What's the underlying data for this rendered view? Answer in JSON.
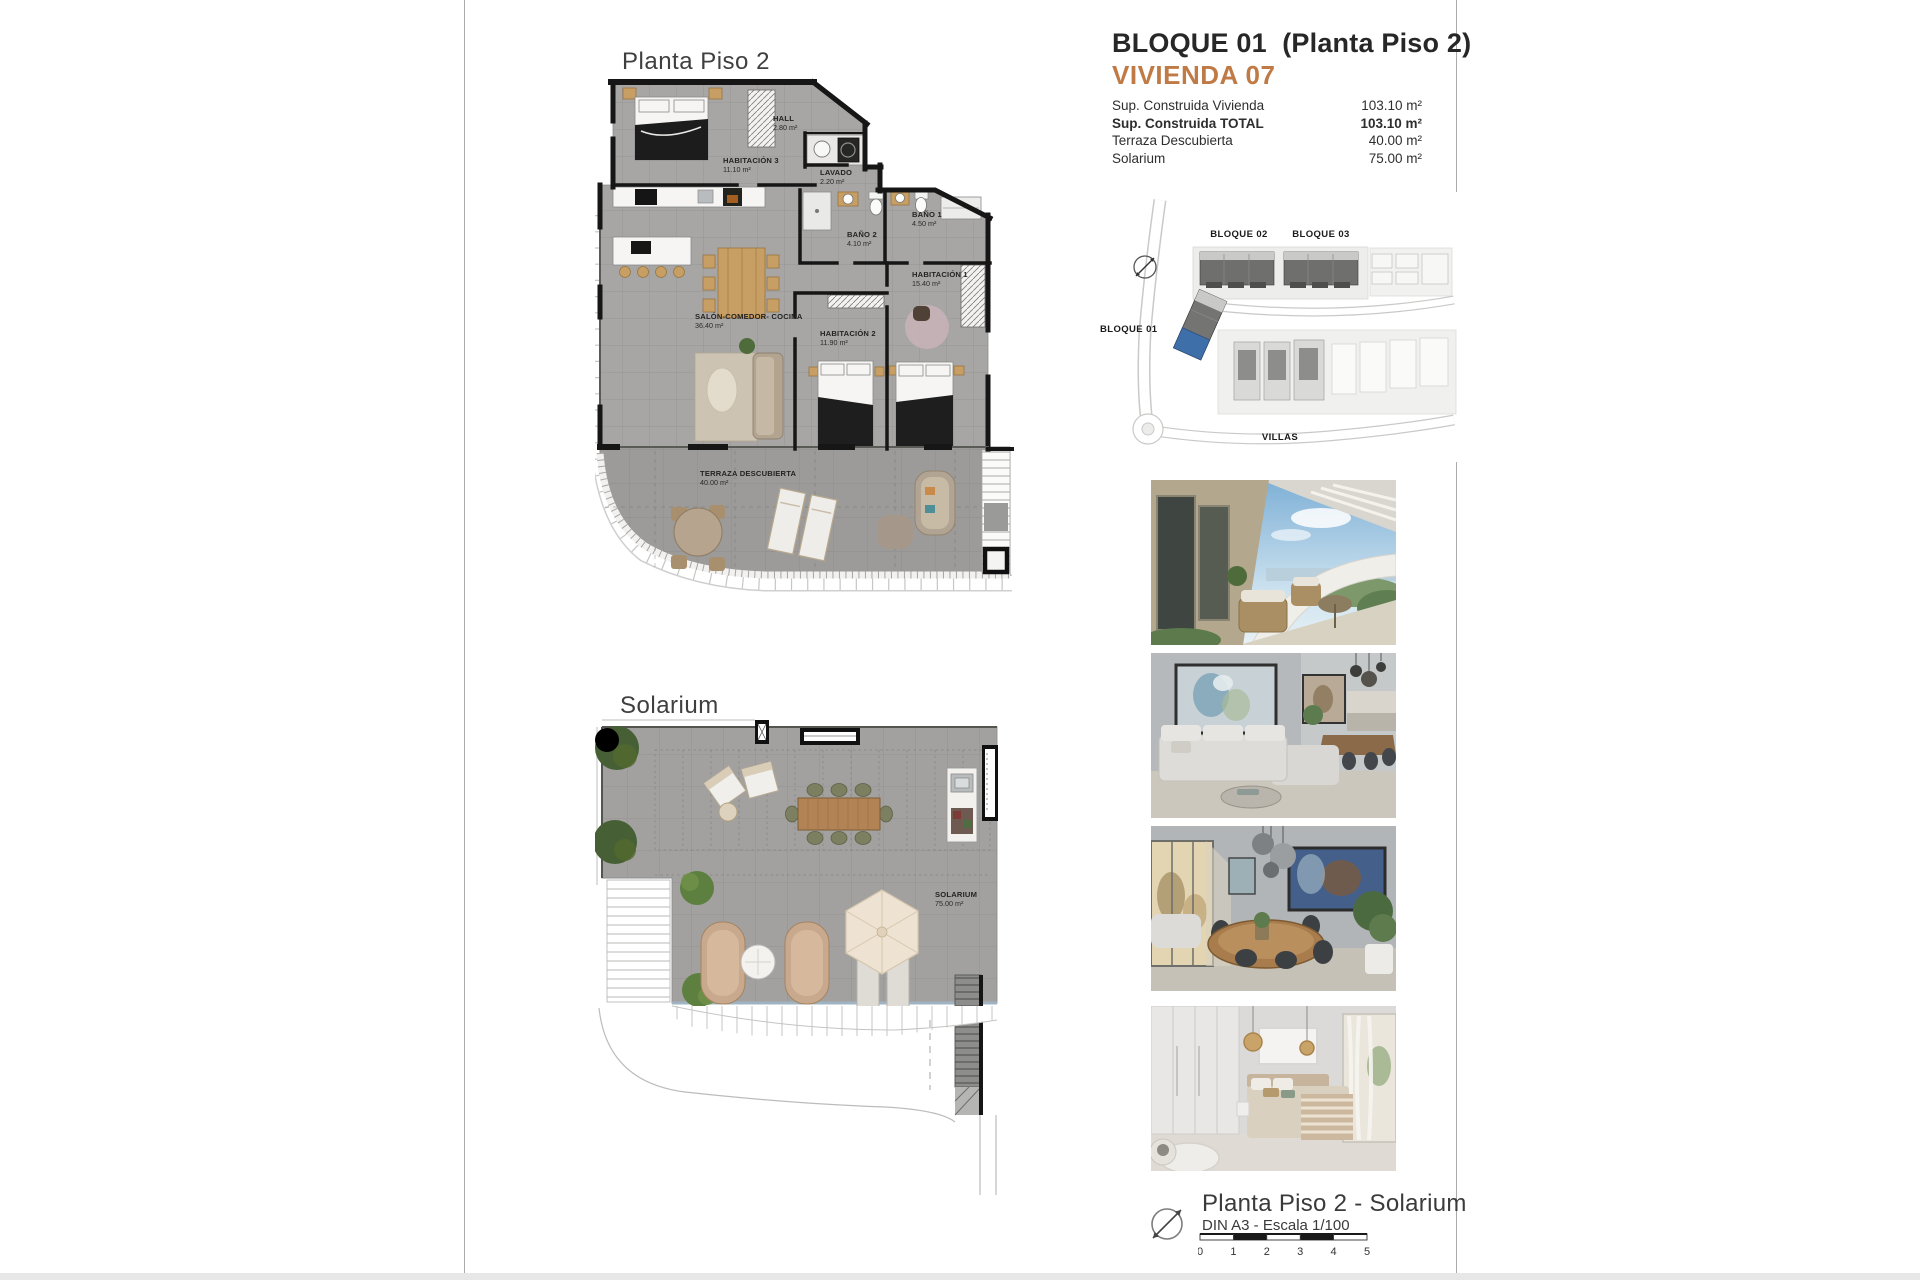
{
  "header": {
    "title": "BLOQUE 01  (Planta Piso 2)",
    "subtitle": "VIVIENDA 07",
    "accent_color": "#bf7a45",
    "rows": [
      {
        "label": "Sup. Construida Vivienda",
        "value": "103.10 m²"
      },
      {
        "label": "Sup. Construida TOTAL",
        "value": "103.10 m²"
      },
      {
        "label": "Terraza Descubierta",
        "value": "40.00 m²"
      },
      {
        "label": "Solarium",
        "value": "75.00 m²"
      }
    ]
  },
  "plan_piso2": {
    "title": "Planta Piso 2",
    "rooms": {
      "habitacion3": {
        "name": "HABITACIÓN 3",
        "area": "11.10 m²"
      },
      "hall": {
        "name": "HALL",
        "area": "2.80 m²"
      },
      "lavado": {
        "name": "LAVADO",
        "area": "2.20 m²"
      },
      "bano2": {
        "name": "BAÑO 2",
        "area": "4.10 m²"
      },
      "bano1": {
        "name": "BAÑO 1",
        "area": "4.50 m²"
      },
      "habitacion1": {
        "name": "HABITACIÓN 1",
        "area": "15.40 m²"
      },
      "habitacion2": {
        "name": "HABITACIÓN 2",
        "area": "11.90 m²"
      },
      "salon": {
        "name": "SALÓN-COMEDOR- COCINA",
        "area": "36.40 m²"
      },
      "terraza": {
        "name": "TERRAZA DESCUBIERTA",
        "area": "40.00 m²"
      }
    }
  },
  "plan_solarium": {
    "title": "Solarium",
    "rooms": {
      "solarium": {
        "name": "SOLARIUM",
        "area": "75.00 m²"
      }
    }
  },
  "site_plan": {
    "bloque01": "BLOQUE 01",
    "bloque02": "BLOQUE 02",
    "bloque03": "BLOQUE 03",
    "villas": "VILLAS",
    "highlight_color": "#3f6fa8"
  },
  "photos": [
    {
      "name": "terrace-balcony"
    },
    {
      "name": "living-room"
    },
    {
      "name": "dining-area"
    },
    {
      "name": "bedroom"
    }
  ],
  "footer": {
    "title": "Planta Piso 2 - Solarium",
    "scale_label": "DIN A3 - Escala 1/100",
    "scale_ticks": [
      "0",
      "1",
      "2",
      "3",
      "4",
      "5"
    ]
  }
}
